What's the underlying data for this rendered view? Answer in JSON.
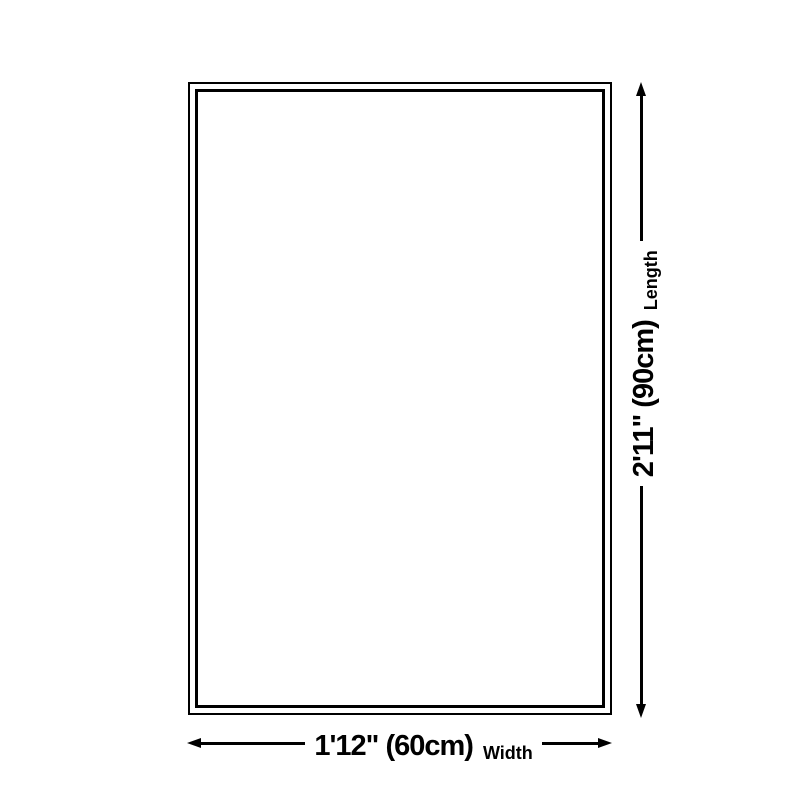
{
  "colors": {
    "background": "#ffffff",
    "outline": "#000000",
    "text": "#000000"
  },
  "rug_diagram": {
    "width_dimension": {
      "value": "1'12\" (60cm)",
      "label": "Width"
    },
    "length_dimension": {
      "value": "2'11\" (90cm)",
      "label": "Length"
    }
  }
}
